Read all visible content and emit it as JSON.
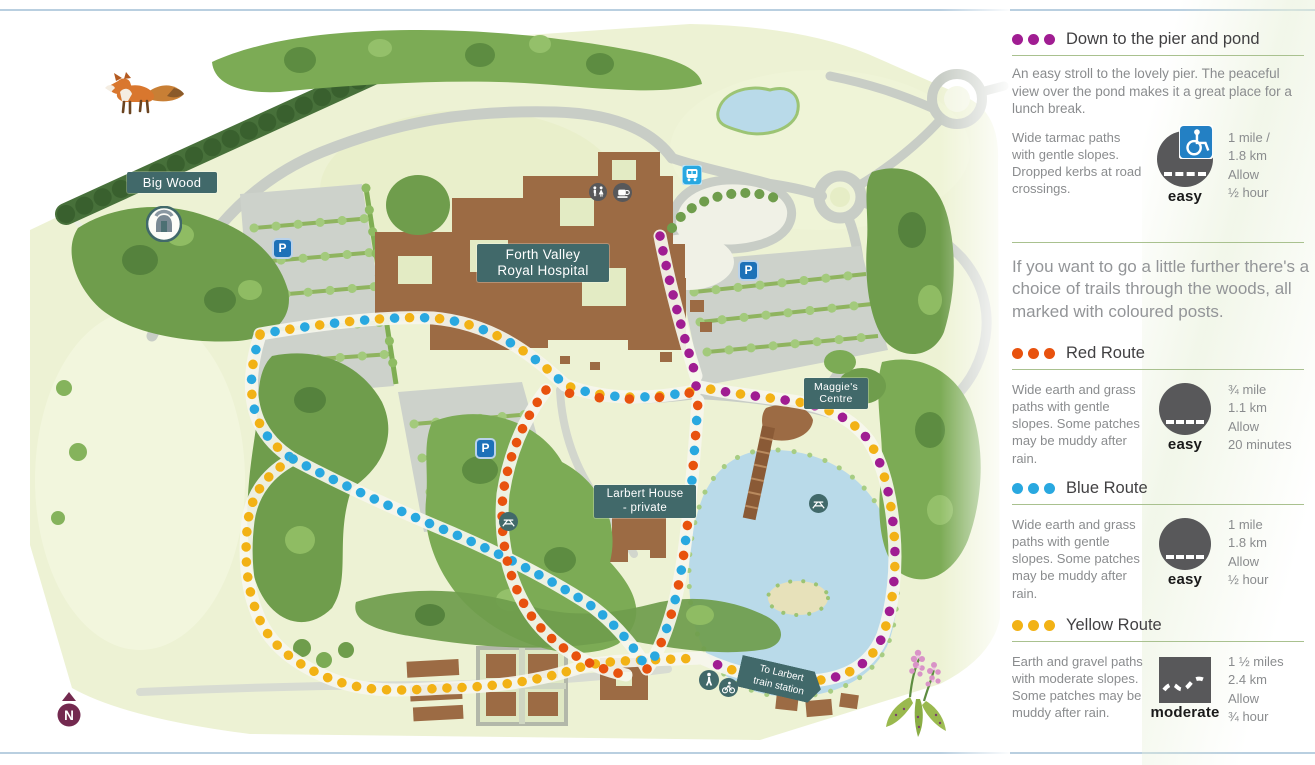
{
  "colors": {
    "purple": "#a01d92",
    "red": "#e8520e",
    "blue": "#29a8e0",
    "yellow": "#f2b215",
    "teal": "#41696a",
    "badge_gray": "#58585a",
    "access_blue": "#2380c4",
    "parking_blue": "#1d71b8",
    "bus_blue": "#29a8e0",
    "compass_purple": "#73294f"
  },
  "map": {
    "labels": {
      "big_wood": "Big Wood",
      "hospital_line1": "Forth Valley",
      "hospital_line2": "Royal Hospital",
      "maggies_line1": "Maggie's",
      "maggies_line2": "Centre",
      "larbert_line1": "Larbert House",
      "larbert_line2": "- private",
      "train_line1": "To Larbert",
      "train_line2": "train station",
      "parking": "P",
      "compass_n": "N"
    }
  },
  "legend": {
    "interlude": "If you want to go a little further there's a choice of trails through the woods, all marked with coloured posts.",
    "sections": [
      {
        "title": "Down to the pier and pond",
        "description": "An easy stroll to the lovely pier. The peaceful view over the pond makes it a great place for a lunch break.",
        "surface": "Wide tarmac paths with gentle slopes. Dropped kerbs at road crossings.",
        "difficulty": "easy",
        "stats": [
          "1 mile /",
          "1.8 km",
          "Allow",
          "½ hour"
        ]
      },
      {
        "title": "Red Route",
        "surface": "Wide earth and grass paths with gentle slopes. Some patches may be muddy after rain.",
        "difficulty": "easy",
        "stats": [
          "¾ mile",
          "1.1 km",
          "Allow",
          "20 minutes"
        ]
      },
      {
        "title": "Blue Route",
        "surface": "Wide earth and grass paths with gentle slopes. Some patches may be muddy after rain.",
        "difficulty": "easy",
        "stats": [
          "1 mile",
          "1.8 km",
          "Allow",
          "½ hour"
        ]
      },
      {
        "title": "Yellow Route",
        "surface": "Earth and gravel paths with moderate slopes. Some patches may be muddy after rain.",
        "difficulty": "moderate",
        "stats": [
          "1 ½ miles",
          "2.4 km",
          "Allow",
          "¾ hour"
        ]
      }
    ]
  }
}
